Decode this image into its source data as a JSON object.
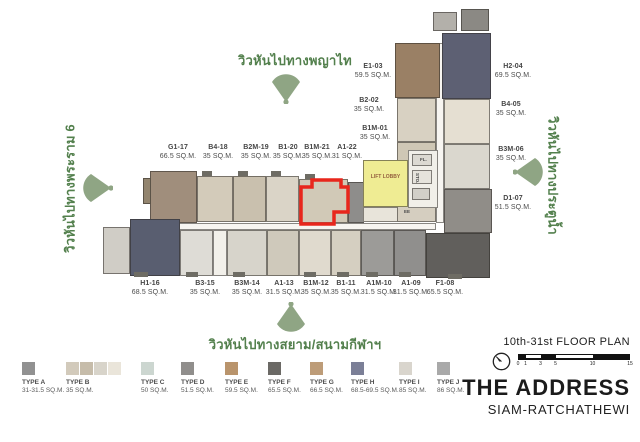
{
  "views": {
    "top": "วิวหันไปทางพญาไท",
    "left": "วิวหันไปทางพระราม 6",
    "right": "วิวหันไปทางประตูน้ำ",
    "bottom": "วิวหันไปทางสยาม/สนามกีฬาฯ"
  },
  "core": {
    "lift_lobby": "LIFT LOBBY",
    "fl": "FL.",
    "sto": "STO.",
    "ee": "EE"
  },
  "units": [
    {
      "id": "G1-17",
      "area": "66.5 SQ.M."
    },
    {
      "id": "B4-18",
      "area": "35 SQ.M."
    },
    {
      "id": "B2M-19",
      "area": "35 SQ.M."
    },
    {
      "id": "B1-20",
      "area": "35 SQ.M."
    },
    {
      "id": "B1M-21",
      "area": "35 SQ.M.",
      "highlighted": true
    },
    {
      "id": "A1-22",
      "area": "31 SQ.M."
    },
    {
      "id": "E1-03",
      "area": "59.5 SQ.M."
    },
    {
      "id": "B2-02",
      "area": "35 SQ.M."
    },
    {
      "id": "B1M-01",
      "area": "35 SQ.M."
    },
    {
      "id": "H2-04",
      "area": "69.5 SQ.M."
    },
    {
      "id": "B4-05",
      "area": "35 SQ.M."
    },
    {
      "id": "B3M-06",
      "area": "35 SQ.M."
    },
    {
      "id": "D1-07",
      "area": "51.5 SQ.M."
    },
    {
      "id": "H1-16",
      "area": "68.5 SQ.M."
    },
    {
      "id": "B3-15",
      "area": "35 SQ.M."
    },
    {
      "id": "B3M-14",
      "area": "35 SQ.M."
    },
    {
      "id": "A1-13",
      "area": "31.5 SQ.M."
    },
    {
      "id": "B1M-12",
      "area": "35 SQ.M."
    },
    {
      "id": "B1-11",
      "area": "35 SQ.M."
    },
    {
      "id": "A1M-10",
      "area": "31.5 SQ.M."
    },
    {
      "id": "A1-09",
      "area": "31.5 SQ.M."
    },
    {
      "id": "F1-08",
      "area": "65.5 SQ.M."
    }
  ],
  "legend": [
    {
      "type": "TYPE A",
      "size": "31-31.5 SQ.M.",
      "colors": [
        "#919191"
      ]
    },
    {
      "type": "TYPE B",
      "size": "35 SQ.M.",
      "colors": [
        "#d2cabb",
        "#c6bcaa",
        "#d8d4ca",
        "#eae5da"
      ]
    },
    {
      "type": "TYPE C",
      "size": "50 SQ.M.",
      "colors": [
        "#ccd6d0"
      ]
    },
    {
      "type": "TYPE D",
      "size": "51.5 SQ.M.",
      "colors": [
        "#908e8c"
      ]
    },
    {
      "type": "TYPE E",
      "size": "59.5 SQ.M.",
      "colors": [
        "#b9946c"
      ]
    },
    {
      "type": "TYPE F",
      "size": "65.5 SQ.M.",
      "colors": [
        "#6b6965"
      ]
    },
    {
      "type": "TYPE G",
      "size": "66.5 SQ.M.",
      "colors": [
        "#bd9c78"
      ]
    },
    {
      "type": "TYPE H",
      "size": "68.5-69.5 SQ.M.",
      "colors": [
        "#7b7f97"
      ]
    },
    {
      "type": "TYPE I",
      "size": "85 SQ.M.",
      "colors": [
        "#d9d5cd"
      ]
    },
    {
      "type": "TYPE J",
      "size": "86 SQ.M.",
      "colors": [
        "#a9a9a9"
      ]
    }
  ],
  "footer": {
    "floor_plan": "10th-31st FLOOR PLAN",
    "brand": "THE ADDRESS",
    "sub_brand": "SIAM-RATCHATHEWI",
    "scale_ticks": [
      "0",
      "1",
      "3",
      "5",
      "10",
      "15"
    ]
  },
  "highlight_color": "#e8261c",
  "lobby_color": "#efec93",
  "view_green": "#53804d",
  "fan_green": "#8fa584"
}
